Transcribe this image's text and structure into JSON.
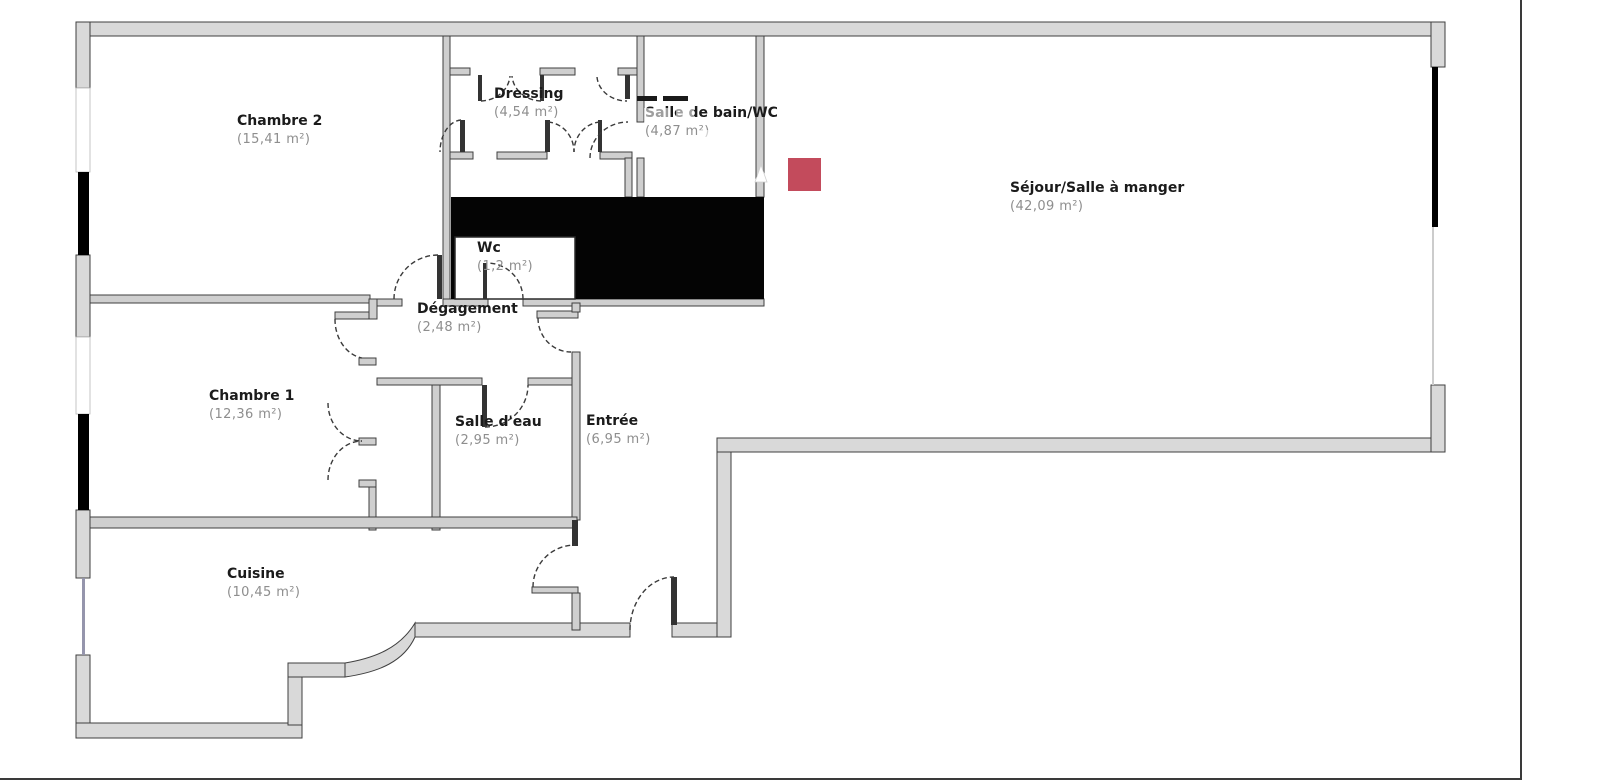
{
  "floorplan": {
    "type": "apartment-floor-plan",
    "rooms": [
      {
        "id": "chambre-2",
        "name": "Chambre 2",
        "area": "(15,41 m²)"
      },
      {
        "id": "dressing",
        "name": "Dressing",
        "area": "(4,54 m²)"
      },
      {
        "id": "salle-de-bain-wc",
        "name": "Salle de bain/WC",
        "area": "(4,87 m²)"
      },
      {
        "id": "sejour",
        "name": "Séjour/Salle à manger",
        "area": "(42,09 m²)"
      },
      {
        "id": "wc",
        "name": "Wc",
        "area": "(1,2 m²)"
      },
      {
        "id": "degagement",
        "name": "Dégagement",
        "area": "(2,48 m²)"
      },
      {
        "id": "chambre-1",
        "name": "Chambre 1",
        "area": "(12,36 m²)"
      },
      {
        "id": "salle-d-eau",
        "name": "Salle d'eau",
        "area": "(2,95 m²)"
      },
      {
        "id": "entree",
        "name": "Entrée",
        "area": "(6,95 m²)"
      },
      {
        "id": "cuisine",
        "name": "Cuisine",
        "area": "(10,45 m²)"
      }
    ]
  },
  "colors": {
    "wall_fill": "#d9d9d9",
    "wall_stroke": "#3f3f3f",
    "iwall_fill": "#cfcfcf",
    "shaft": "#040404",
    "win_black": "#000000",
    "marker_red": "#c34b5c",
    "frame": "#3a3a3a",
    "name_color": "#1b1b1b",
    "area_color": "#8e8e8e",
    "window_line": "#9595ac",
    "arc_color": "#3a3a3a"
  }
}
